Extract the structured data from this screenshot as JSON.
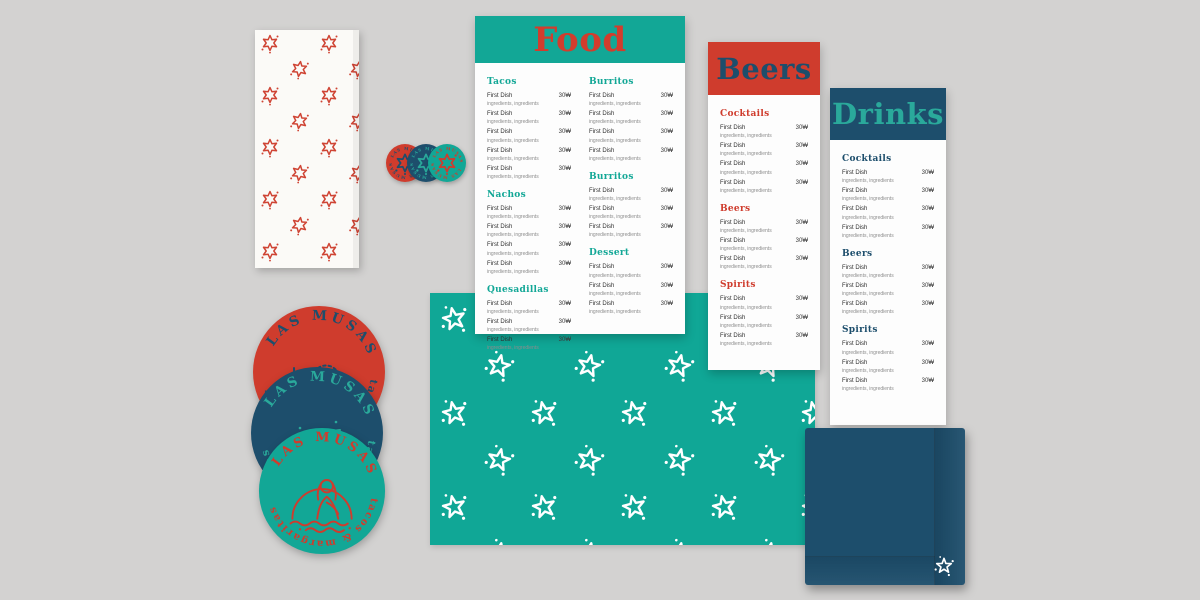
{
  "background_color": "#d3d2d1",
  "brand": {
    "name": "LAS MUSAS",
    "circle_text_top": "LAS MUSAS",
    "circle_text_bottom": "tacos & margaritas"
  },
  "colors": {
    "teal": "#12a796",
    "red": "#cf3c2d",
    "navy": "#1d4e6c",
    "paper_white": "#fdfdfd",
    "background_gray": "#d3d2d1"
  },
  "chips": {
    "label": "LAS MUSAS"
  },
  "menus": {
    "food": {
      "title": "Food",
      "columns": [
        {
          "sections": [
            {
              "heading": "Tacos",
              "items": [
                {
                  "name": "First Dish",
                  "description": "ingredients, ingredients",
                  "price": "30₩"
                },
                {
                  "name": "First Dish",
                  "description": "ingredients, ingredients",
                  "price": "30₩"
                },
                {
                  "name": "First Dish",
                  "description": "ingredients, ingredients",
                  "price": "30₩"
                },
                {
                  "name": "First Dish",
                  "description": "ingredients, ingredients",
                  "price": "30₩"
                },
                {
                  "name": "First Dish",
                  "description": "ingredients, ingredients",
                  "price": "30₩"
                }
              ]
            },
            {
              "heading": "Nachos",
              "items": [
                {
                  "name": "First Dish",
                  "description": "ingredients, ingredients",
                  "price": "30₩"
                },
                {
                  "name": "First Dish",
                  "description": "ingredients, ingredients",
                  "price": "30₩"
                },
                {
                  "name": "First Dish",
                  "description": "ingredients, ingredients",
                  "price": "30₩"
                },
                {
                  "name": "First Dish",
                  "description": "ingredients, ingredients",
                  "price": "30₩"
                }
              ]
            },
            {
              "heading": "Quesadillas",
              "items": [
                {
                  "name": "First Dish",
                  "description": "ingredients, ingredients",
                  "price": "30₩"
                },
                {
                  "name": "First Dish",
                  "description": "ingredients, ingredients",
                  "price": "30₩"
                },
                {
                  "name": "First Dish",
                  "description": "ingredients, ingredients",
                  "price": "30₩"
                }
              ]
            }
          ]
        },
        {
          "sections": [
            {
              "heading": "Burritos",
              "items": [
                {
                  "name": "First Dish",
                  "description": "ingredients, ingredients",
                  "price": "30₩"
                },
                {
                  "name": "First Dish",
                  "description": "ingredients, ingredients",
                  "price": "30₩"
                },
                {
                  "name": "First Dish",
                  "description": "ingredients, ingredients",
                  "price": "30₩"
                },
                {
                  "name": "First Dish",
                  "description": "ingredients, ingredients",
                  "price": "30₩"
                }
              ]
            },
            {
              "heading": "Burritos",
              "items": [
                {
                  "name": "First Dish",
                  "description": "ingredients, ingredients",
                  "price": "30₩"
                },
                {
                  "name": "First Dish",
                  "description": "ingredients, ingredients",
                  "price": "30₩"
                },
                {
                  "name": "First Dish",
                  "description": "ingredients, ingredients",
                  "price": "30₩"
                }
              ]
            },
            {
              "heading": "Dessert",
              "items": [
                {
                  "name": "First Dish",
                  "description": "ingredients, ingredients",
                  "price": "30₩"
                },
                {
                  "name": "First Dish",
                  "description": "ingredients, ingredients",
                  "price": "30₩"
                },
                {
                  "name": "First Dish",
                  "description": "ingredients, ingredients",
                  "price": "30₩"
                }
              ]
            }
          ]
        }
      ]
    },
    "beers": {
      "title": "Beers",
      "sections": [
        {
          "heading": "Cocktails",
          "items": [
            {
              "name": "First Dish",
              "description": "ingredients, ingredients",
              "price": "30₩"
            },
            {
              "name": "First Dish",
              "description": "ingredients, ingredients",
              "price": "30₩"
            },
            {
              "name": "First Dish",
              "description": "ingredients, ingredients",
              "price": "30₩"
            },
            {
              "name": "First Dish",
              "description": "ingredients, ingredients",
              "price": "30₩"
            }
          ]
        },
        {
          "heading": "Beers",
          "items": [
            {
              "name": "First Dish",
              "description": "ingredients, ingredients",
              "price": "30₩"
            },
            {
              "name": "First Dish",
              "description": "ingredients, ingredients",
              "price": "30₩"
            },
            {
              "name": "First Dish",
              "description": "ingredients, ingredients",
              "price": "30₩"
            }
          ]
        },
        {
          "heading": "Spirits",
          "items": [
            {
              "name": "First Dish",
              "description": "ingredients, ingredients",
              "price": "30₩"
            },
            {
              "name": "First Dish",
              "description": "ingredients, ingredients",
              "price": "30₩"
            },
            {
              "name": "First Dish",
              "description": "ingredients, ingredients",
              "price": "30₩"
            }
          ]
        }
      ]
    },
    "drinks": {
      "title": "Drinks",
      "sections": [
        {
          "heading": "Cocktails",
          "items": [
            {
              "name": "First Dish",
              "description": "ingredients, ingredients",
              "price": "30₩"
            },
            {
              "name": "First Dish",
              "description": "ingredients, ingredients",
              "price": "30₩"
            },
            {
              "name": "First Dish",
              "description": "ingredients, ingredients",
              "price": "30₩"
            },
            {
              "name": "First Dish",
              "description": "ingredients, ingredients",
              "price": "30₩"
            }
          ]
        },
        {
          "heading": "Beers",
          "items": [
            {
              "name": "First Dish",
              "description": "ingredients, ingredients",
              "price": "30₩"
            },
            {
              "name": "First Dish",
              "description": "ingredients, ingredients",
              "price": "30₩"
            },
            {
              "name": "First Dish",
              "description": "ingredients, ingredients",
              "price": "30₩"
            }
          ]
        },
        {
          "heading": "Spirits",
          "items": [
            {
              "name": "First Dish",
              "description": "ingredients, ingredients",
              "price": "30₩"
            },
            {
              "name": "First Dish",
              "description": "ingredients, ingredients",
              "price": "30₩"
            },
            {
              "name": "First Dish",
              "description": "ingredients, ingredients",
              "price": "30₩"
            }
          ]
        }
      ]
    }
  }
}
